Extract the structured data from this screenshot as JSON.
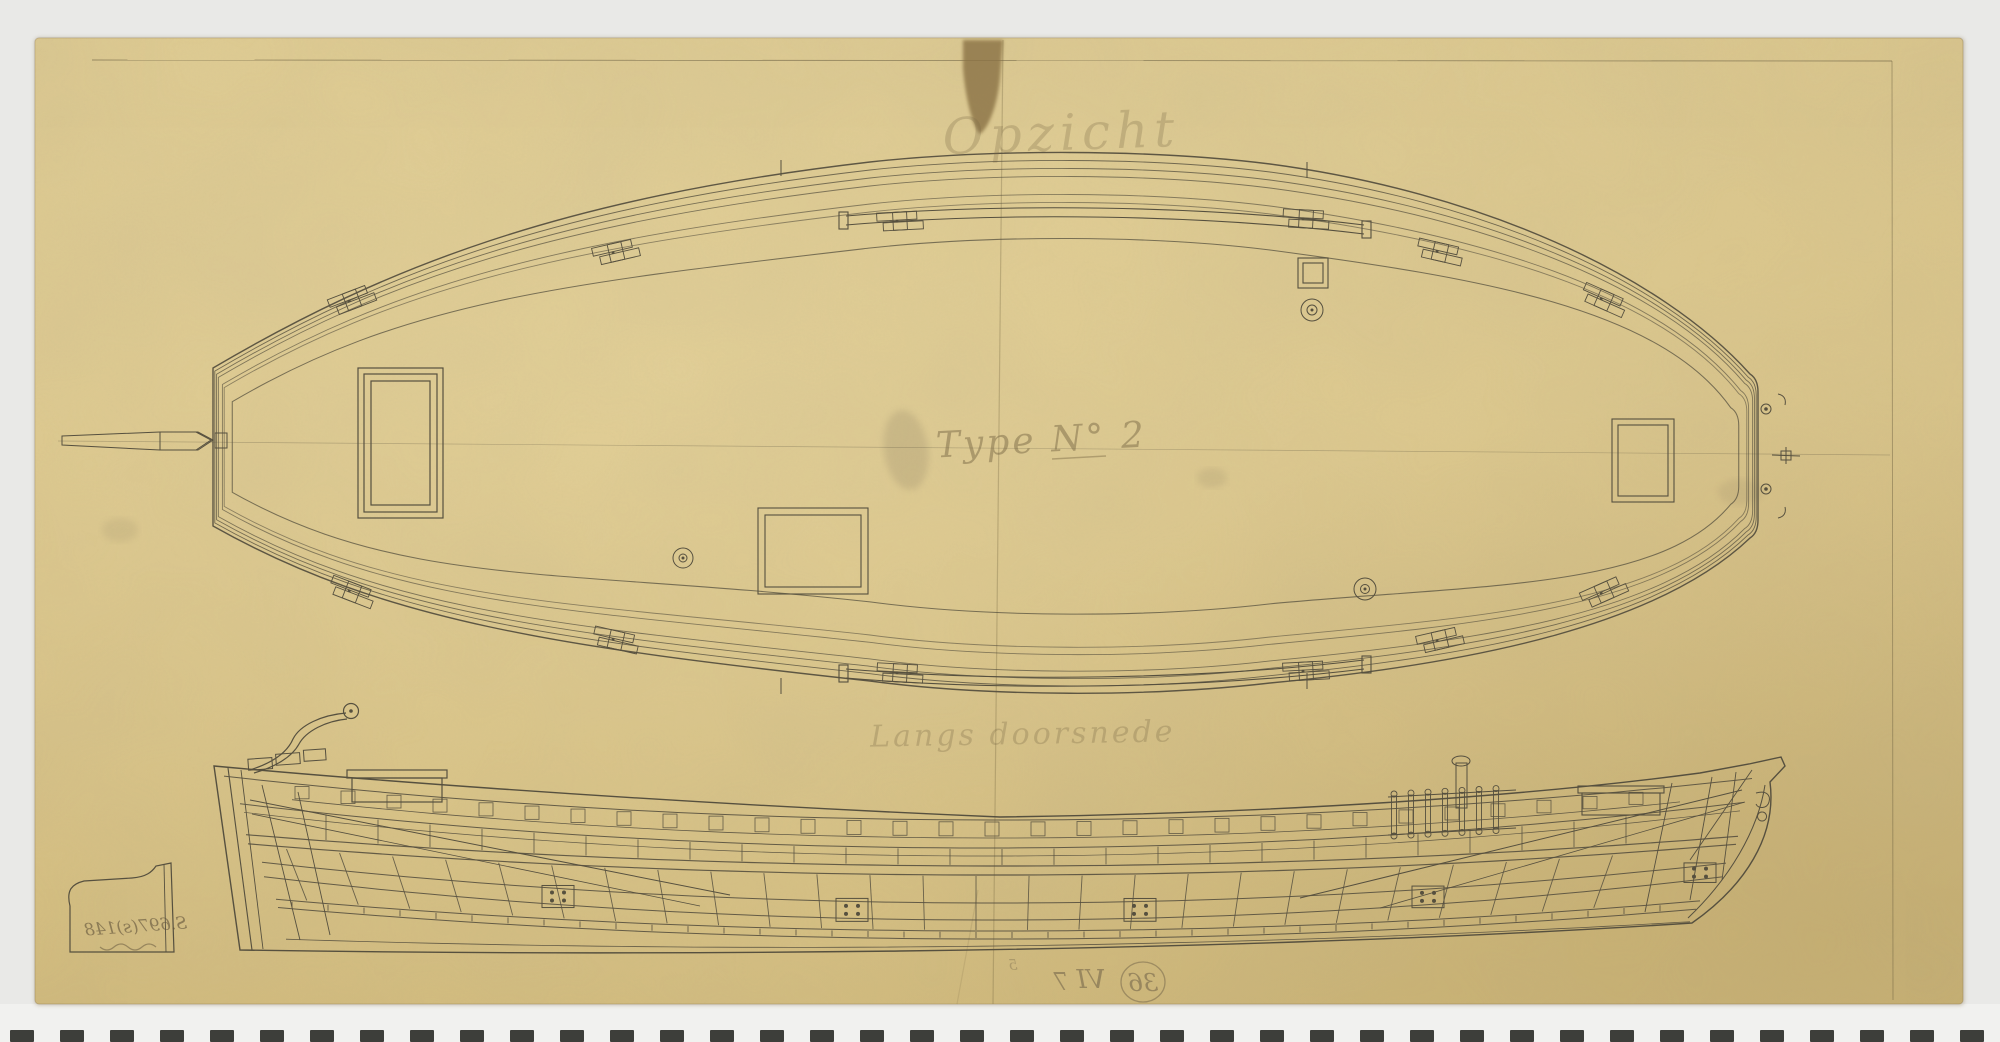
{
  "annotations": {
    "top_view_label": "Opzicht",
    "type_label": "Type N° 2",
    "side_view_label": "Langs doorsnede",
    "inventory_number_mirrored": "S.697(s)148",
    "folio_circle_number_mirrored": "36",
    "folio_roman_mirrored": "VI",
    "folio_digit_mirrored": "7",
    "margin_mark": "5"
  },
  "colors": {
    "scan_background": "#e9e9e7",
    "film_strip_background": "#f1f1ef",
    "film_strip_dash": "#3d3e3a",
    "paper": "#d8c286",
    "paper_edge": "#c9b274",
    "ink_line": "#56503f",
    "pencil_text": "#7c6b47",
    "tape_stain": "#8a7244"
  }
}
